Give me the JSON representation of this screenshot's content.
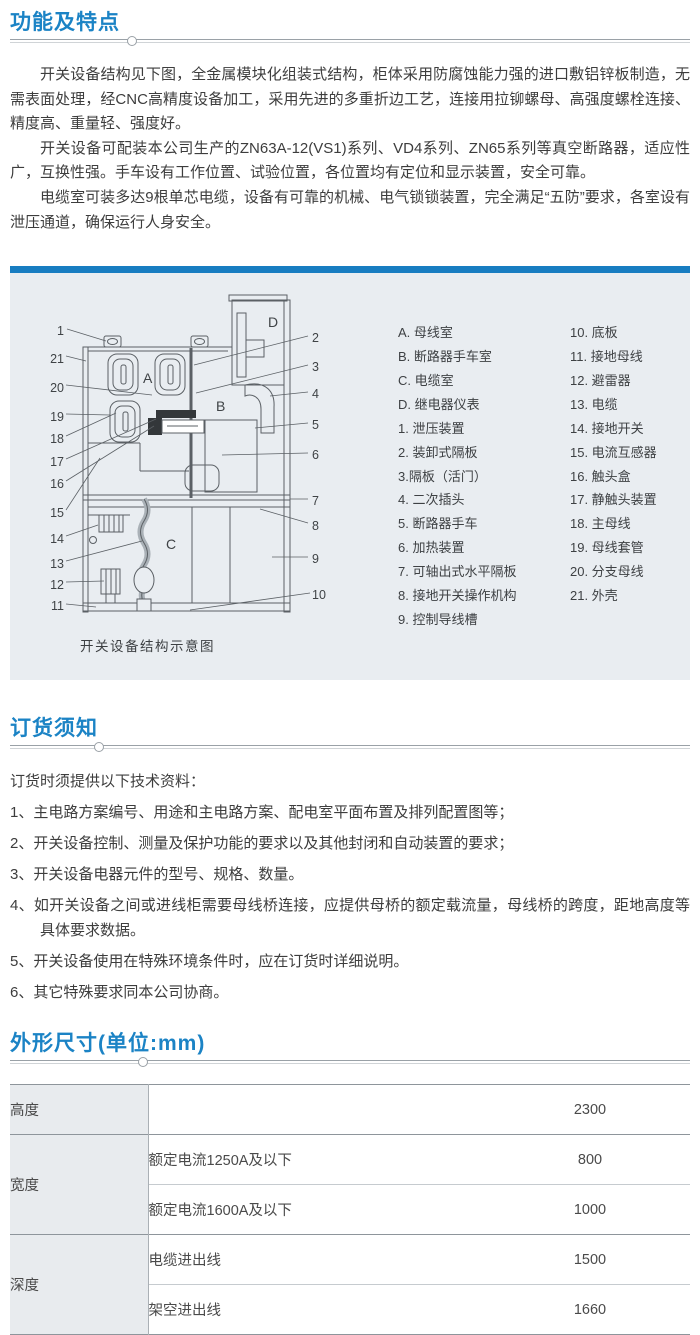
{
  "sections": {
    "features": {
      "title": "功能及特点",
      "paragraphs": [
        "开关设备结构见下图，全金属模块化组装式结构，柜体采用防腐蚀能力强的进口敷铝锌板制造，无需表面处理，经CNC高精度设备加工，采用先进的多重折边工艺，连接用拉铆螺母、高强度螺栓连接、精度高、重量轻、强度好。",
        "开关设备可配装本公司生产的ZN63A-12(VS1)系列、VD4系列、ZN65系列等真空断路器，适应性广，互换性强。手车设有工作位置、试验位置，各位置均有定位和显示装置，安全可靠。",
        "电缆室可装多达9根单芯电缆，设备有可靠的机械、电气锁锁装置，完全满足“五防”要求，各室设有泄压通道，确保运行人身安全。"
      ]
    },
    "diagram": {
      "caption": "开关设备结构示意图",
      "compartments": [
        "A",
        "B",
        "C",
        "D"
      ],
      "callouts_left": [
        "1",
        "21",
        "20",
        "19",
        "18",
        "17",
        "16",
        "15",
        "14",
        "13",
        "12",
        "11"
      ],
      "callouts_right": [
        "2",
        "3",
        "4",
        "5",
        "6",
        "7",
        "8",
        "9",
        "10"
      ],
      "legend_left": [
        "A. 母线室",
        "B. 断路器手车室",
        "C. 电缆室",
        "D. 继电器仪表",
        "1. 泄压装置",
        "2. 装卸式隔板",
        "3.隔板（活门）",
        "4. 二次插头",
        "5. 断路器手车",
        "6. 加热装置",
        "7. 可轴出式水平隔板",
        "8. 接地开关操作机构",
        "9. 控制导线槽"
      ],
      "legend_right": [
        "10. 底板",
        "11. 接地母线",
        "12. 避雷器",
        "13. 电缆",
        "14. 接地开关",
        "15. 电流互感器",
        "16. 触头盒",
        "17. 静触头装置",
        "18. 主母线",
        "19. 母线套管",
        "20. 分支母线",
        "21. 外壳"
      ]
    },
    "ordering": {
      "title": "订货须知",
      "intro": "订货时须提供以下技术资料：",
      "items": [
        "1、主电路方案编号、用途和主电路方案、配电室平面布置及排列配置图等；",
        "2、开关设备控制、测量及保护功能的要求以及其他封闭和自动装置的要求；",
        "3、开关设备电器元件的型号、规格、数量。",
        "4、如开关设备之间或进线柜需要母线桥连接，应提供母桥的额定载流量，母线桥的跨度，距地高度等具体要求数据。",
        "5、开关设备使用在特殊环境条件时，应在订货时详细说明。",
        "6、其它特殊要求同本公司协商。"
      ]
    },
    "dimensions": {
      "title": "外形尺寸(单位:mm)",
      "table": {
        "groups": [
          {
            "label": "高度",
            "rows": [
              {
                "condition": "",
                "value": "2300"
              }
            ]
          },
          {
            "label": "宽度",
            "rows": [
              {
                "condition": "额定电流1250A及以下",
                "value": "800"
              },
              {
                "condition": "额定电流1600A及以下",
                "value": "1000"
              }
            ]
          },
          {
            "label": "深度",
            "rows": [
              {
                "condition": "电缆进出线",
                "value": "1500"
              },
              {
                "condition": "架空进出线",
                "value": "1660"
              }
            ]
          }
        ]
      }
    }
  },
  "colors": {
    "accent_blue": "#1b83c5",
    "panel_bar_blue": "#187dc1",
    "panel_bg": "#e9edf1",
    "table_label_bg": "#e8ebee"
  }
}
